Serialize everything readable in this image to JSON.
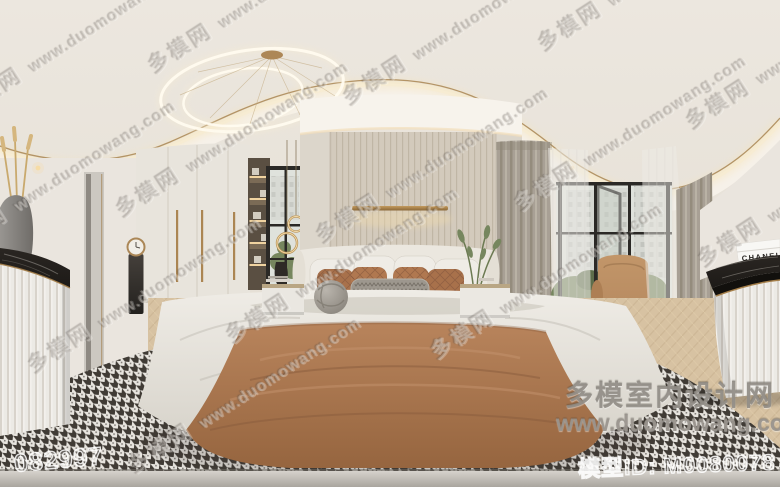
{
  "watermarks": {
    "tile": {
      "site_name": "多模网",
      "site_url": "www.duomowang.com"
    },
    "brand": {
      "name": "多模室内设计网",
      "url": "www.duomowang.com"
    },
    "scene_number": "082997",
    "model_id": "模型ID: M0080078"
  },
  "decor": {
    "chanel_box_label": "CHANEL"
  },
  "colors": {
    "ceiling": "#ece7df",
    "ceiling_band": "#f6f1e9",
    "cove_glow": "#f5e3ba",
    "brass": "#a57f4a",
    "wall": "#eae5de",
    "wardrobe": "#e8e4dc",
    "slat_wall": "#d3cabc",
    "niche_wood": "#5a4f42",
    "shelf_glow": "#f0d3a0",
    "curtain": "#a8a095",
    "sheer": "#edebe6",
    "window_frame": "#2b2926",
    "glass_sky": "#dfe2dc",
    "foliage": "#76865e",
    "floor_wood": "#d7c2a2",
    "rug_light": "#e7e4de",
    "rug_dark": "#403b35",
    "marble_black": "#1d1a17",
    "flute_cabinet": "#eceae5",
    "headboard": "#ebe7df",
    "bedding_white": "#efece6",
    "pillow_terracotta": "#ab744d",
    "pillow_gray": "#9d978e",
    "blanket_terracotta": "#ae7a52",
    "armchair_tan": "#b78a60",
    "bottom_band": "#c6c2bb"
  }
}
